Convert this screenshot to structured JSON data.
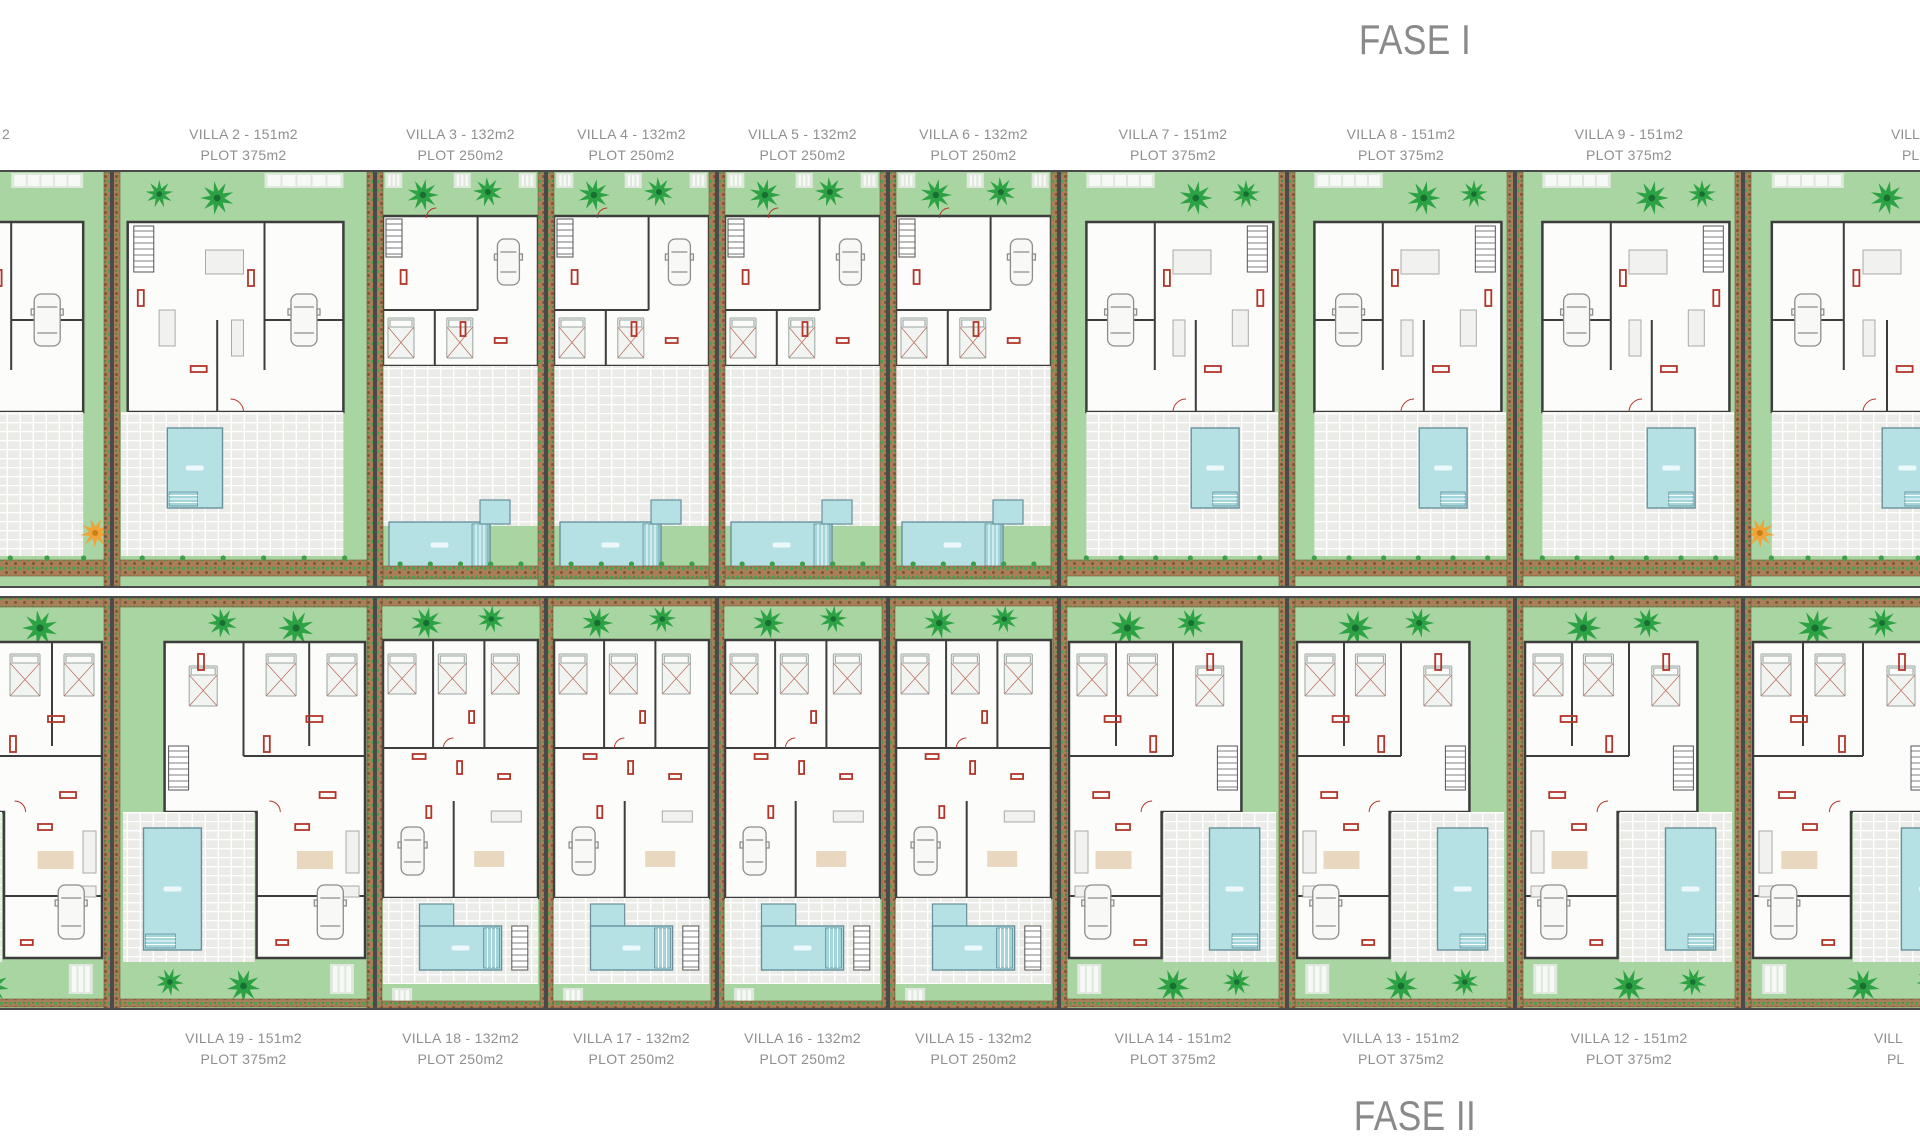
{
  "phase_titles": {
    "top": "FASE I",
    "bottom": "FASE II"
  },
  "colors": {
    "garden": "#a9d5a2",
    "garden_path": "#dfe8dc",
    "pool": "#b5e1e5",
    "pool_edge": "#66909c",
    "palm_green": "#2ca244",
    "palm_dark": "#176f31",
    "orange_tree": "#f0a339",
    "hedge_brown": "#a87f58",
    "wall_dark": "#3d3d3d",
    "accent_red": "#b23529",
    "terrace_tile": "#ebebe7",
    "label_text": "#8f8f8f",
    "title_text": "#8a8a8a"
  },
  "top_row": {
    "phase": "FASE I",
    "villas": [
      {
        "id": "villa-2",
        "name": "VILLA 2 - 151m2",
        "plot": "PLOT 375m2"
      },
      {
        "id": "villa-3",
        "name": "VILLA 3 - 132m2",
        "plot": "PLOT 250m2"
      },
      {
        "id": "villa-4",
        "name": "VILLA 4 - 132m2",
        "plot": "PLOT 250m2"
      },
      {
        "id": "villa-5",
        "name": "VILLA 5 - 132m2",
        "plot": "PLOT 250m2"
      },
      {
        "id": "villa-6",
        "name": "VILLA 6 - 132m2",
        "plot": "PLOT 250m2"
      },
      {
        "id": "villa-7",
        "name": "VILLA 7 - 151m2",
        "plot": "PLOT 375m2"
      },
      {
        "id": "villa-8",
        "name": "VILLA 8 - 151m2",
        "plot": "PLOT 375m2"
      },
      {
        "id": "villa-9",
        "name": "VILLA 9 - 151m2",
        "plot": "PLOT 375m2"
      }
    ]
  },
  "bottom_row": {
    "phase": "FASE II",
    "villas": [
      {
        "id": "villa-19",
        "name": "VILLA 19 - 151m2",
        "plot": "PLOT 375m2"
      },
      {
        "id": "villa-18",
        "name": "VILLA 18 - 132m2",
        "plot": "PLOT 250m2"
      },
      {
        "id": "villa-17",
        "name": "VILLA 17 - 132m2",
        "plot": "PLOT 250m2"
      },
      {
        "id": "villa-16",
        "name": "VILLA 16 - 132m2",
        "plot": "PLOT 250m2"
      },
      {
        "id": "villa-15",
        "name": "VILLA 15 - 132m2",
        "plot": "PLOT 250m2"
      },
      {
        "id": "villa-14",
        "name": "VILLA 14 - 151m2",
        "plot": "PLOT 375m2"
      },
      {
        "id": "villa-13",
        "name": "VILLA 13 - 151m2",
        "plot": "PLOT 375m2"
      },
      {
        "id": "villa-12",
        "name": "VILLA 12 - 151m2",
        "plot": "PLOT 375m2"
      }
    ]
  },
  "edge_fragments": {
    "top_left": "2",
    "top_right_line1": "VILLA",
    "top_right_line2": "PL",
    "bottom_right_line1": "VILL",
    "bottom_right_line2": "PL"
  }
}
